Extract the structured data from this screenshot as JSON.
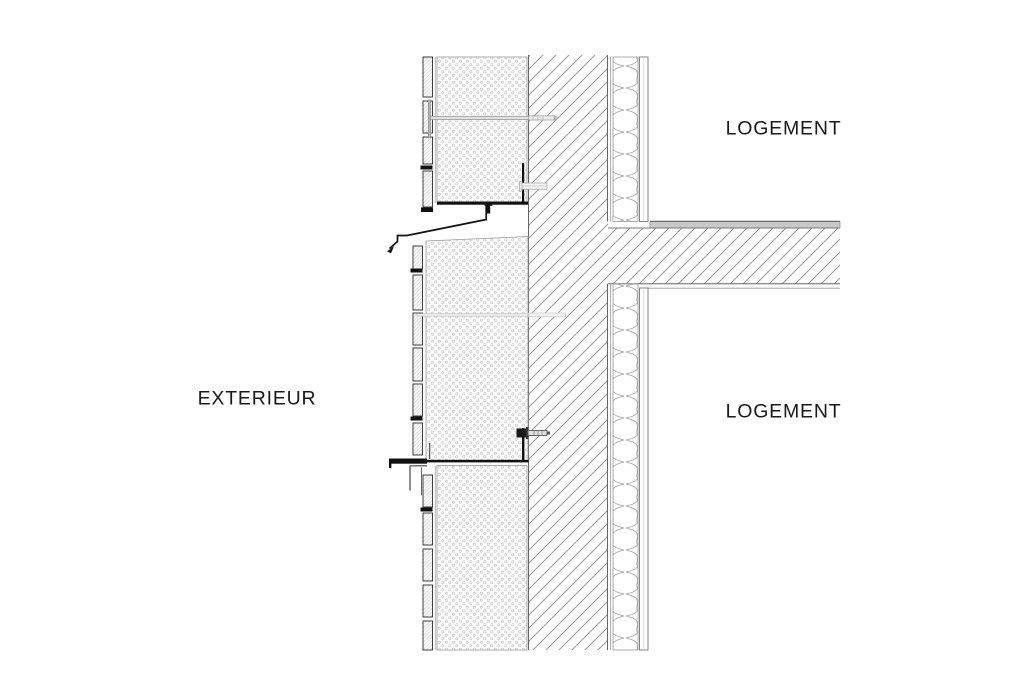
{
  "drawing": {
    "title": "wall-section-detail",
    "labels": {
      "exterior": "EXTERIEUR",
      "logement_upper": "LOGEMENT",
      "logement_lower": "LOGEMENT"
    },
    "colors": {
      "background": "#ffffff",
      "text": "#1a1a1a",
      "outline_dark": "#111111",
      "line_medium": "#666666",
      "hatch_gray": "#999999",
      "insulation_dot_gray": "#c6c6c6",
      "batt_squiggle_gray": "#b0b0b0",
      "screed_fill": "#c9c9c9",
      "anchor_gray": "#9a9a9a"
    }
  }
}
